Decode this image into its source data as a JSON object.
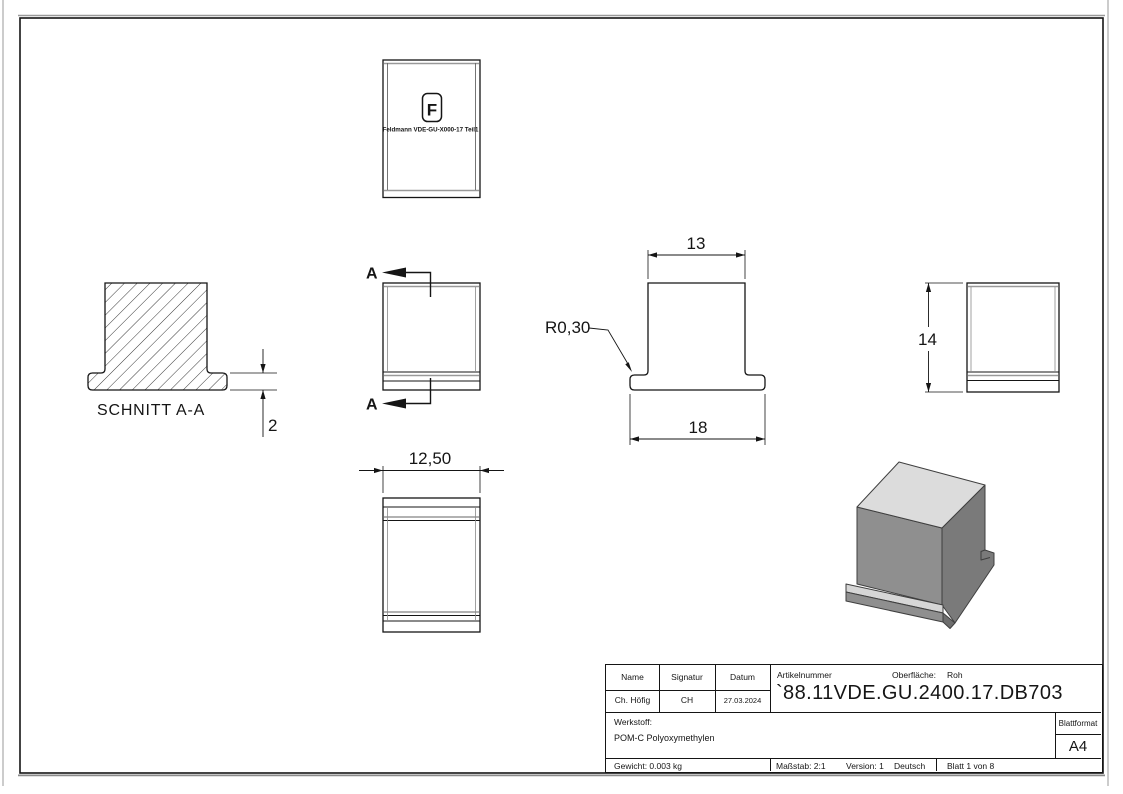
{
  "drawing": {
    "section_view": {
      "label": "SCHNITT A-A",
      "dim_thickness": "2"
    },
    "front_view": {
      "cut_label_top": "A",
      "cut_label_bottom": "A"
    },
    "top_view": {
      "logo_letter": "F",
      "logo_caption": "Feldmann VDE-GU-X000-17 Teil1"
    },
    "side_view": {
      "dim_width_top": "13",
      "dim_width_bottom": "18",
      "radius_label": "R0,30"
    },
    "right_view": {
      "dim_height": "14"
    },
    "bottom_view": {
      "dim_depth": "12,50"
    }
  },
  "title_block": {
    "name_label": "Name",
    "signatur_label": "Signatur",
    "datum_label": "Datum",
    "name_value": "Ch. Höfig",
    "signatur_value": "CH",
    "datum_value": "27.03.2024",
    "artikelnummer_label": "Artikelnummer",
    "artikelnummer_value": "`88.11VDE.GU.2400.17.DB703",
    "oberflaeche_label": "Oberfläche:",
    "oberflaeche_value": "Roh",
    "werkstoff_label": "Werkstoff:",
    "werkstoff_value": "POM-C Polyoxymethylen",
    "blattformat_label": "Blattformat",
    "blattformat_value": "A4",
    "gewicht_value": "Gewicht: 0.003 kg",
    "massstab_value": "Maßstab: 2:1",
    "version_value": "Version: 1",
    "sprache_value": "Deutsch",
    "blatt_value": "Blatt 1 von 8"
  },
  "colors": {
    "line": "#151515",
    "tangent_edge": "#999999",
    "iso_top": "#dcdcdc",
    "iso_front": "#8f8f8f",
    "iso_right": "#7a7a7a"
  }
}
